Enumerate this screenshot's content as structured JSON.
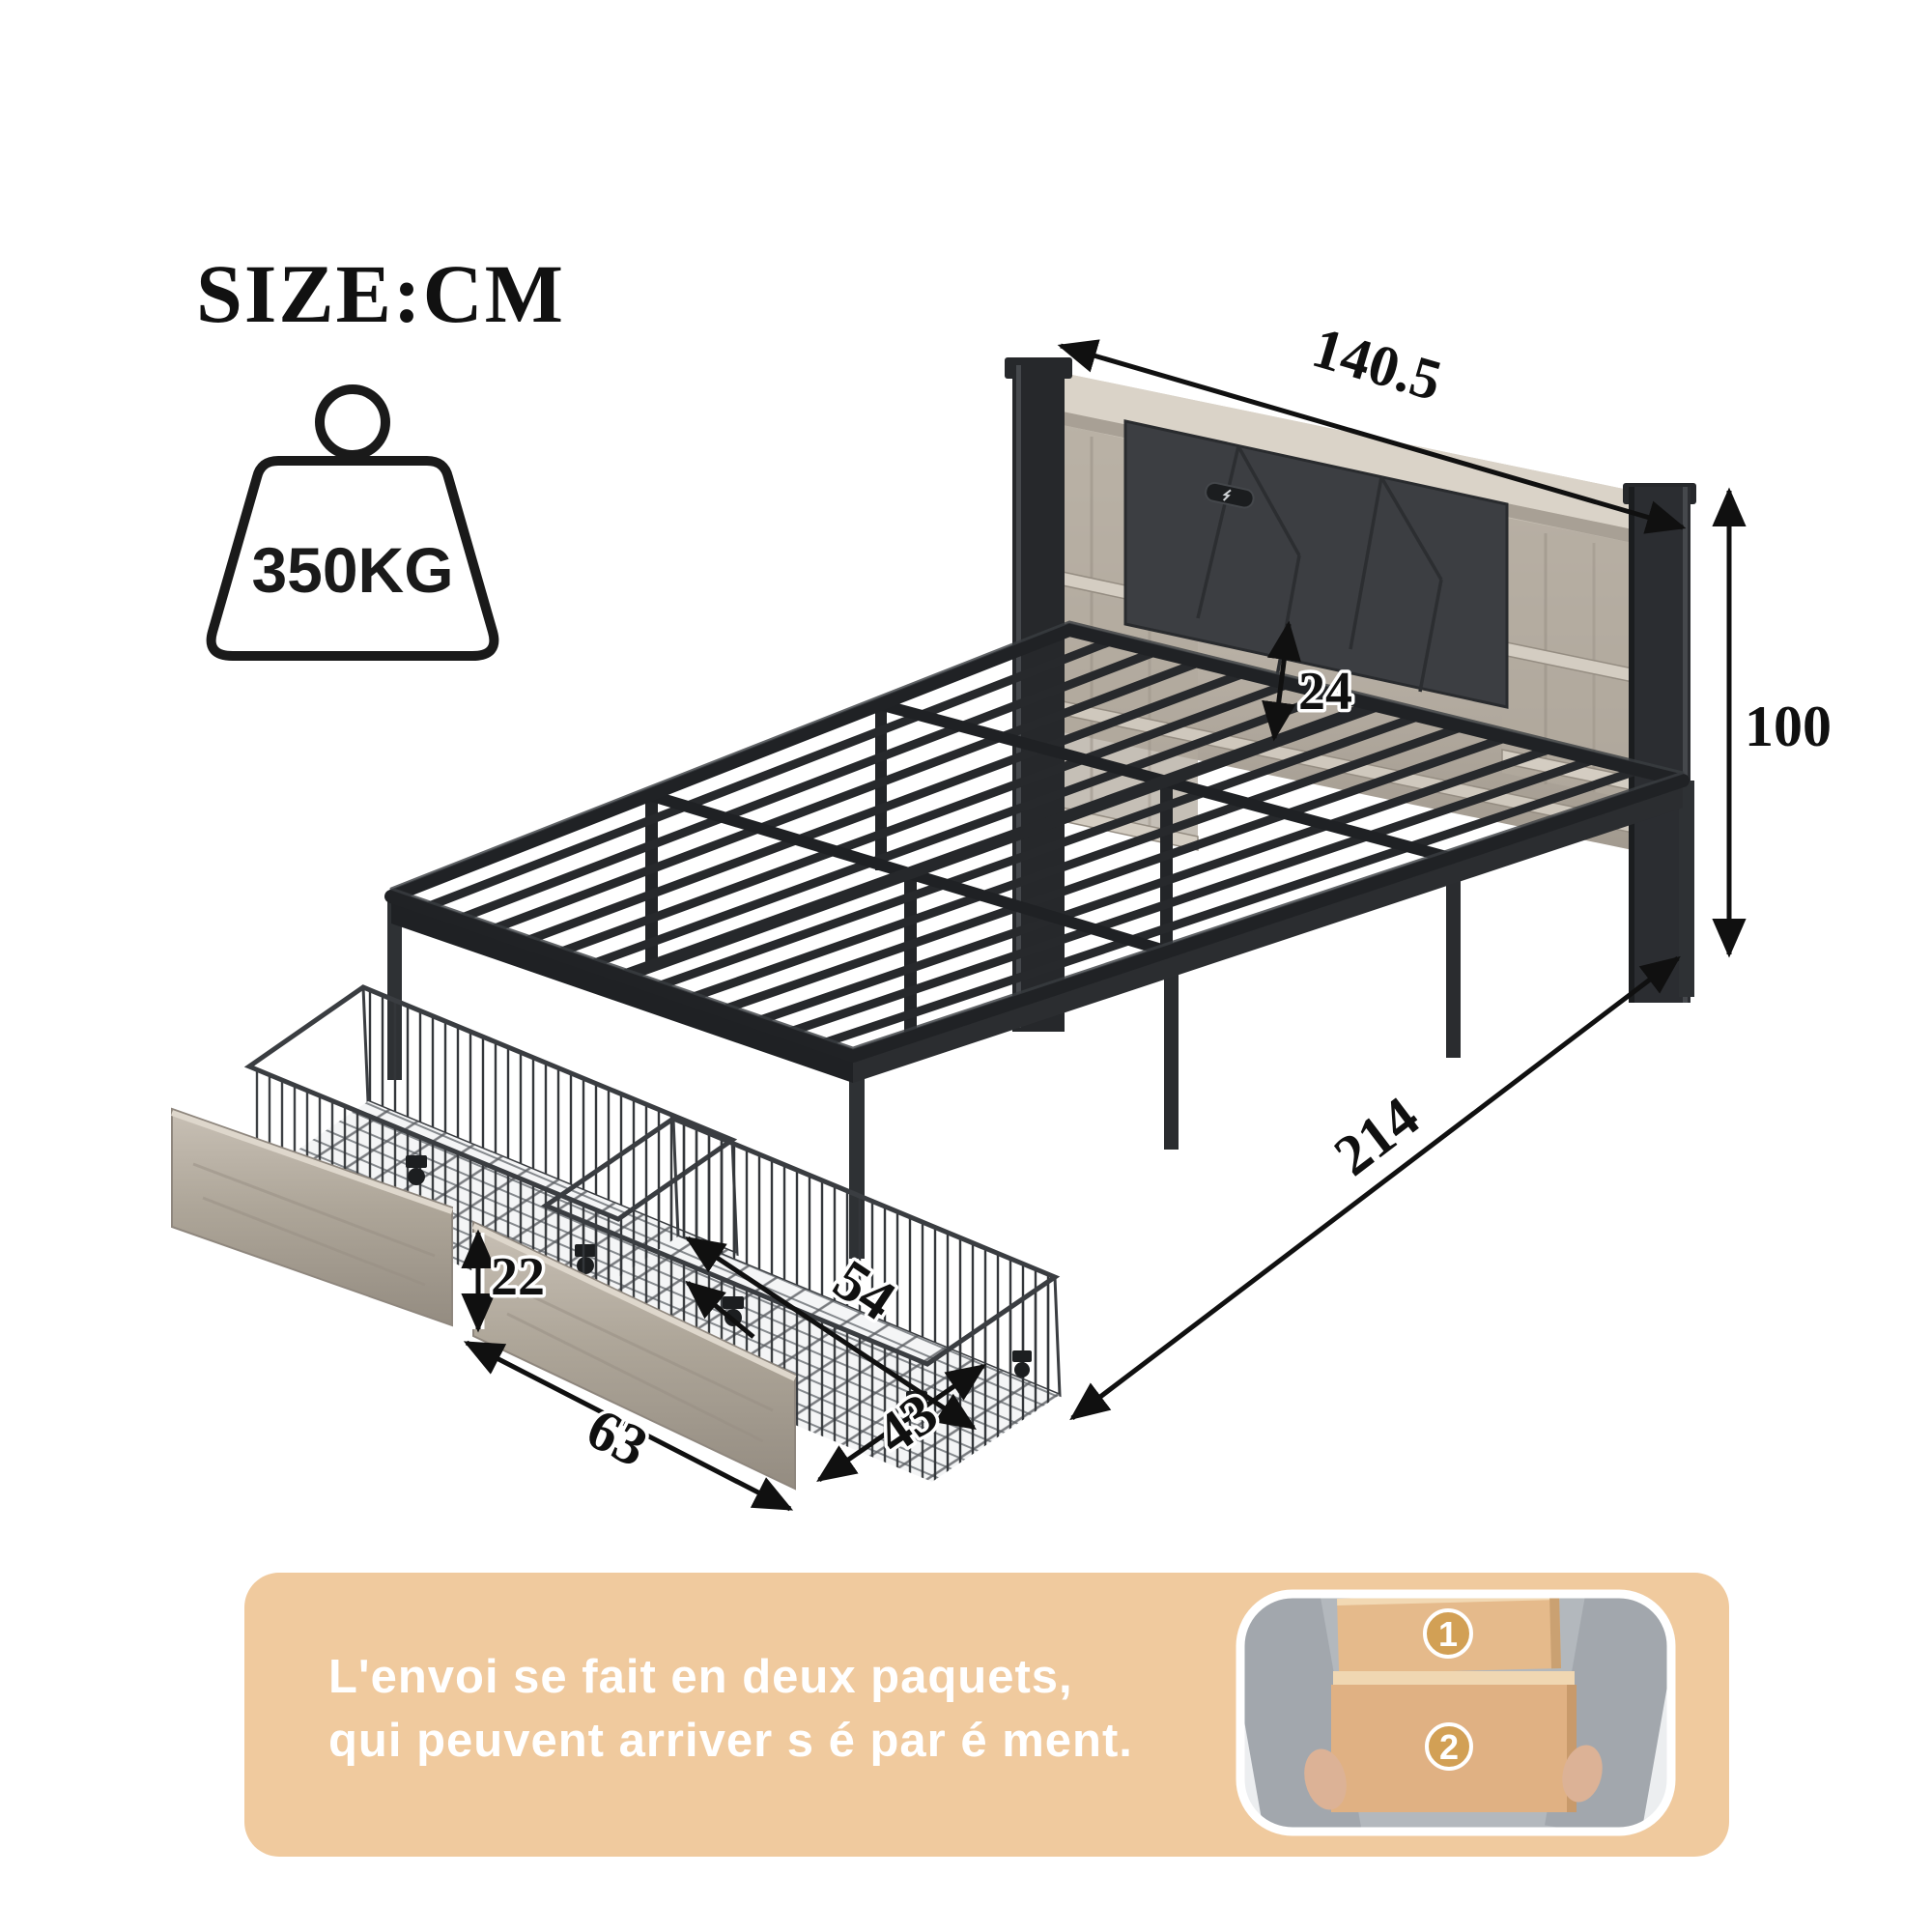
{
  "title": {
    "label": "SIZE:CM"
  },
  "weight_badge": {
    "label": "350KG"
  },
  "dimensions": {
    "headboard_width": "140.5",
    "total_height": "100",
    "headboard_to_slats": "24",
    "bed_length": "214",
    "basket_length": "54",
    "drawer_height": "22",
    "drawer_front_length": "63",
    "drawer_depth": "43"
  },
  "shipping": {
    "line1": "L'envoi se fait en deux paquets,",
    "line2": "qui peuvent arriver s é par é ment.",
    "package1": "1",
    "package2": "2"
  },
  "colors": {
    "banner": "#F0CA9E",
    "metal": "#26282B",
    "wood": "#BEB6AB",
    "cushion": "#3C3E42",
    "badge": "#D2A055"
  }
}
